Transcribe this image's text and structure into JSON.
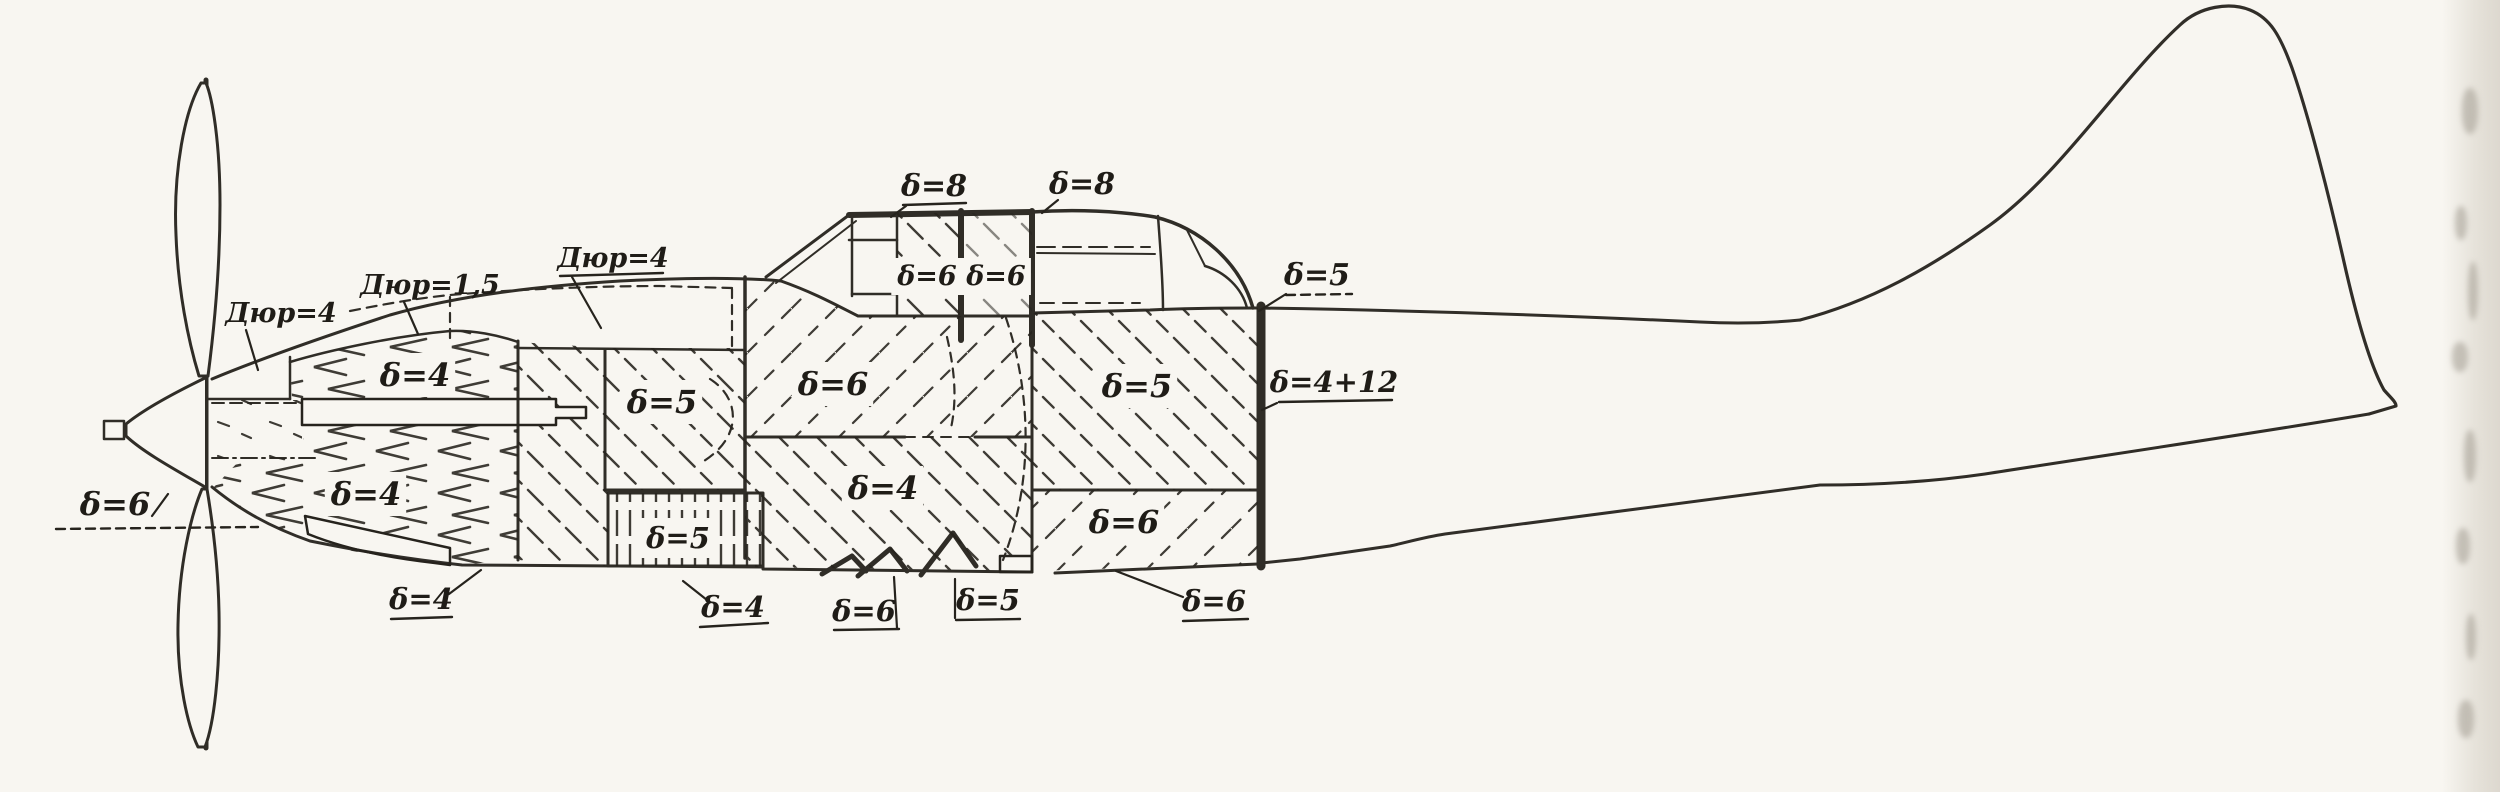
{
  "canvas": {
    "width": 2500,
    "height": 792,
    "paper": "#f8f6f1",
    "ink": "#26231d"
  },
  "drawing": {
    "subject": "aircraft-side-view-armor-thickness-scheme",
    "delta_symbol": "δ"
  },
  "annotations": [
    {
      "name": "label-dur4-front",
      "text": "Дюр=4",
      "x": 281,
      "y": 322,
      "size": 27,
      "leader": [
        [
          246,
          330
        ],
        [
          258,
          370
        ]
      ]
    },
    {
      "name": "label-dur1-5",
      "text": "Дюр=1,5",
      "x": 430,
      "y": 294,
      "size": 27,
      "leader": [
        [
          404,
          302
        ],
        [
          418,
          334
        ]
      ]
    },
    {
      "name": "label-dur4-top",
      "text": "Дюр=4",
      "x": 613,
      "y": 267,
      "size": 27,
      "underline": [
        560,
        276,
        663,
        273
      ],
      "leader": [
        [
          572,
          277
        ],
        [
          601,
          328
        ]
      ]
    },
    {
      "name": "label-d8-left",
      "text": "δ=8",
      "x": 934,
      "y": 196,
      "size": 30,
      "underline": [
        903,
        205,
        966,
        203
      ],
      "leader": [
        [
          906,
          206
        ],
        [
          891,
          217
        ]
      ]
    },
    {
      "name": "label-d8-right",
      "text": "δ=8",
      "x": 1082,
      "y": 194,
      "size": 30,
      "leader": [
        [
          1058,
          200
        ],
        [
          1042,
          213
        ]
      ]
    },
    {
      "name": "label-d6-canopy-front",
      "text": "δ=6",
      "x": 927,
      "y": 285,
      "size": 27,
      "mask": true
    },
    {
      "name": "label-d6-canopy-rear",
      "text": "δ=6",
      "x": 996,
      "y": 285,
      "size": 27,
      "mask": true
    },
    {
      "name": "label-d5-fairing",
      "text": "δ=5",
      "x": 1317,
      "y": 285,
      "size": 30,
      "underline": [
        1286,
        295,
        1352,
        294
      ],
      "dashed": true,
      "leader": [
        [
          1286,
          294
        ],
        [
          1259,
          311
        ]
      ]
    },
    {
      "name": "label-d4-nose-top",
      "text": "δ=4",
      "x": 415,
      "y": 386,
      "size": 32,
      "mask": true
    },
    {
      "name": "label-d5-mid",
      "text": "δ=5",
      "x": 662,
      "y": 413,
      "size": 32,
      "mask": true
    },
    {
      "name": "label-d6-cockpit",
      "text": "δ=6",
      "x": 833,
      "y": 395,
      "size": 32,
      "mask": true
    },
    {
      "name": "label-d4-floor",
      "text": "δ=4",
      "x": 883,
      "y": 499,
      "size": 32,
      "mask": true
    },
    {
      "name": "label-d5-rear",
      "text": "δ=5",
      "x": 1137,
      "y": 397,
      "size": 32,
      "mask": true
    },
    {
      "name": "label-d4plus12",
      "text": "δ=4+12",
      "x": 1334,
      "y": 392,
      "size": 29,
      "underline": [
        1279,
        402,
        1392,
        400
      ],
      "leader": [
        [
          1277,
          403
        ],
        [
          1262,
          410
        ]
      ]
    },
    {
      "name": "label-d6-rear-lower",
      "text": "δ=6",
      "x": 1124,
      "y": 533,
      "size": 32,
      "mask": true
    },
    {
      "name": "label-d4-nose-big",
      "text": "δ=4",
      "x": 366,
      "y": 505,
      "size": 32,
      "mask": true
    },
    {
      "name": "label-d6-spinner",
      "text": "δ=6",
      "x": 115,
      "y": 515,
      "size": 32,
      "underline": [
        56,
        529,
        258,
        527
      ],
      "dashed": true,
      "leader": [
        [
          152,
          516
        ],
        [
          168,
          494
        ]
      ]
    },
    {
      "name": "label-d5-striped",
      "text": "δ=5",
      "x": 678,
      "y": 548,
      "size": 29,
      "mask": true
    },
    {
      "name": "label-d4-bottom-front",
      "text": "δ=4",
      "x": 733,
      "y": 617,
      "size": 29,
      "underline": [
        700,
        627,
        768,
        623
      ],
      "leader": [
        [
          683,
          581
        ],
        [
          707,
          600
        ]
      ]
    },
    {
      "name": "label-d6-bottom-mid",
      "text": "δ=6",
      "x": 864,
      "y": 621,
      "size": 29,
      "underline": [
        834,
        630,
        899,
        629
      ],
      "leader": [
        [
          897,
          628
        ],
        [
          894,
          577
        ]
      ]
    },
    {
      "name": "label-d5-bottom-mid",
      "text": "δ=5",
      "x": 988,
      "y": 610,
      "size": 29,
      "underline": [
        956,
        620,
        1020,
        619
      ],
      "leader": [
        [
          955,
          618
        ],
        [
          955,
          579
        ]
      ]
    },
    {
      "name": "label-d6-bottom-rear",
      "text": "δ=6",
      "x": 1214,
      "y": 611,
      "size": 29,
      "underline": [
        1183,
        621,
        1248,
        619
      ],
      "leader": [
        [
          1183,
          597
        ],
        [
          1116,
          571
        ]
      ]
    },
    {
      "name": "label-d4-nose-bottom",
      "text": "δ=4",
      "x": 421,
      "y": 609,
      "size": 29,
      "underline": [
        391,
        619,
        452,
        617
      ],
      "leader": [
        [
          449,
          594
        ],
        [
          481,
          570
        ]
      ]
    }
  ]
}
